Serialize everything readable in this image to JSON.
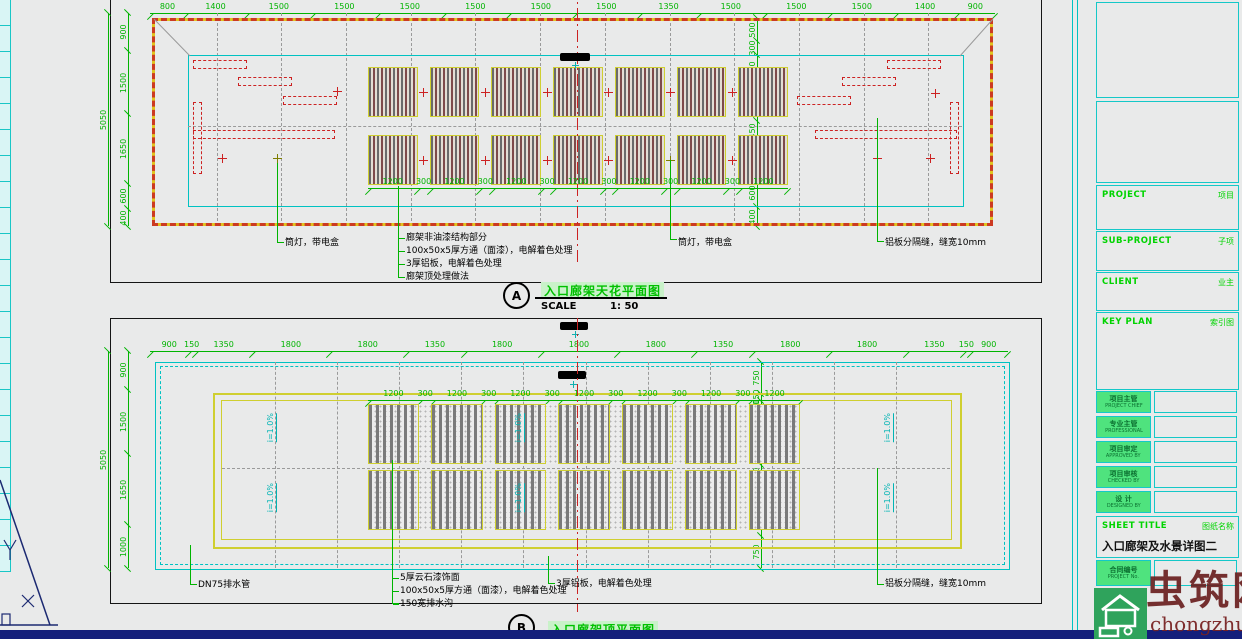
{
  "panel_a": {
    "ref": "A",
    "title": "入口廊架天花平面图",
    "scale_label": "SCALE",
    "scale_value": "1: 50",
    "dims_top": [
      "800",
      "1400",
      "1500",
      "1500",
      "1500",
      "1500",
      "1500",
      "1500",
      "1350",
      "1500",
      "1500",
      "1500",
      "1400",
      "900"
    ],
    "dims_left": [
      "900",
      "1500",
      "1650",
      "600",
      "400"
    ],
    "total_height": "5050",
    "dims_right_inner": [
      "500",
      "300",
      "600",
      "800",
      "450",
      "800",
      "600",
      "400"
    ],
    "dims_inner": [
      "1200",
      "300",
      "1200",
      "300",
      "1200",
      "300",
      "1200",
      "300",
      "1200",
      "300",
      "1200",
      "300",
      "1200"
    ],
    "ann_left": "筒灯，带电盒",
    "ann_center": [
      "廊架非油漆结构部分",
      "100x50x5厚方通（面漆），电解着色处理",
      "3厚铝板，电解着色处理",
      "廊架顶处理做法"
    ],
    "ann_mid": "筒灯，带电盒",
    "ann_right": "铝板分隔缝，缝宽10mm"
  },
  "panel_b": {
    "ref": "B",
    "title": "入口廊架顶平面图",
    "dims_top": [
      "900",
      "150",
      "1350",
      "1800",
      "1800",
      "1350",
      "1800",
      "1800",
      "1800",
      "1350",
      "1800",
      "1800",
      "1350",
      "150",
      "900"
    ],
    "dims_left": [
      "900",
      "1500",
      "1650",
      "1000"
    ],
    "total_height": "5050",
    "dims_right_inner": [
      "750",
      "150",
      "300",
      "1200",
      "450",
      "1200",
      "750"
    ],
    "dims_inner": [
      "1200",
      "300",
      "1200",
      "300",
      "1200",
      "300",
      "1200",
      "300",
      "1200",
      "300",
      "1200",
      "300",
      "1200"
    ],
    "slope": "i=1.0%",
    "ann_left": "DN75排水管",
    "ann_center": [
      "5厚云石漆饰面",
      "100x50x5厚方通（面漆），电解着色处理",
      "150宽排水沟"
    ],
    "ann_mid": "3厚铝板，电解着色处理",
    "ann_right": "铝板分隔缝，缝宽10mm"
  },
  "titleblock": {
    "project_label": "PROJECT",
    "project_cn": "项目",
    "subproject_label": "SUB-PROJECT",
    "subproject_cn": "子项",
    "client_label": "CLIENT",
    "client_cn": "业主",
    "keyplan_label": "KEY PLAN",
    "keyplan_cn": "索引图",
    "rows": [
      {
        "cn": "项目主管",
        "en": "PROJECT CHIEF"
      },
      {
        "cn": "专业主管",
        "en": "PROFESSIONAL"
      },
      {
        "cn": "项目审定",
        "en": "APPROVED BY"
      },
      {
        "cn": "项目审核",
        "en": "CHECKED BY"
      },
      {
        "cn": "设 计",
        "en": "DESIGNED BY"
      }
    ],
    "sheettitle_label": "SHEET TITLE",
    "sheettitle_cn": "图纸名称",
    "sheet_name": "入口廊架及水景详图二",
    "projectno_cn": "合同编号",
    "projectno_en": "PROJECT No."
  },
  "watermark": {
    "brand": "虫筑网",
    "domain": "chongzhu.cn"
  },
  "colors": {
    "background": "#e9eaea",
    "dimension_green": "#00b400",
    "cyan": "#00c2c2",
    "red": "#cc2222",
    "yellow": "#cfcf30",
    "navy_bar": "#141f7b",
    "watermark_red": "#6b1e1e",
    "logo_green": "#2fa35c"
  }
}
